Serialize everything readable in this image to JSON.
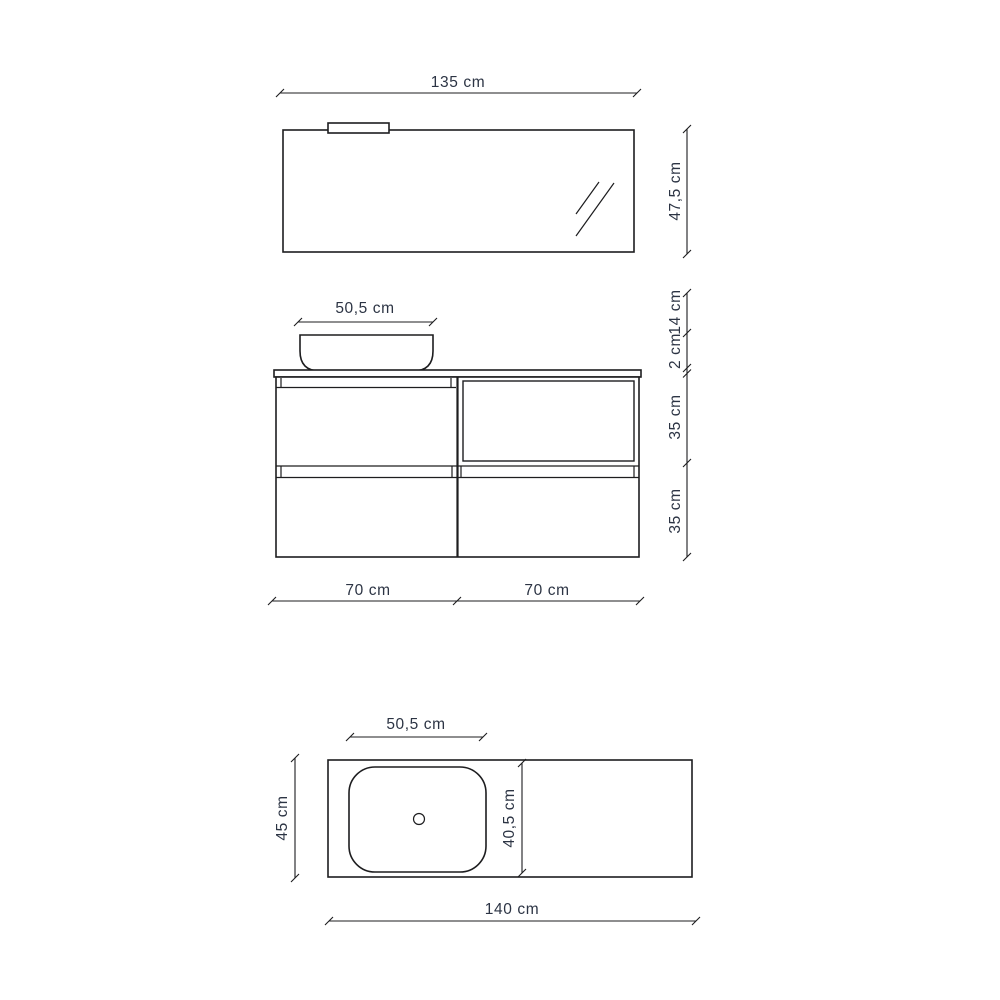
{
  "title": "bathroom-vanity-dimension-diagram",
  "colors": {
    "background": "#ffffff",
    "line": "#1d1d1f",
    "text": "#2c3444"
  },
  "mirror_view": {
    "width_label": "135 cm",
    "height_label": "47,5 cm"
  },
  "front_view": {
    "basin_width_label": "50,5 cm",
    "height_labels": [
      "14 cm",
      "2 cm",
      "35 cm",
      "35 cm"
    ],
    "width_labels": [
      "70 cm",
      "70 cm"
    ]
  },
  "top_view": {
    "basin_width_label": "50,5 cm",
    "basin_depth_label": "40,5 cm",
    "depth_label": "45 cm",
    "width_label": "140 cm"
  }
}
